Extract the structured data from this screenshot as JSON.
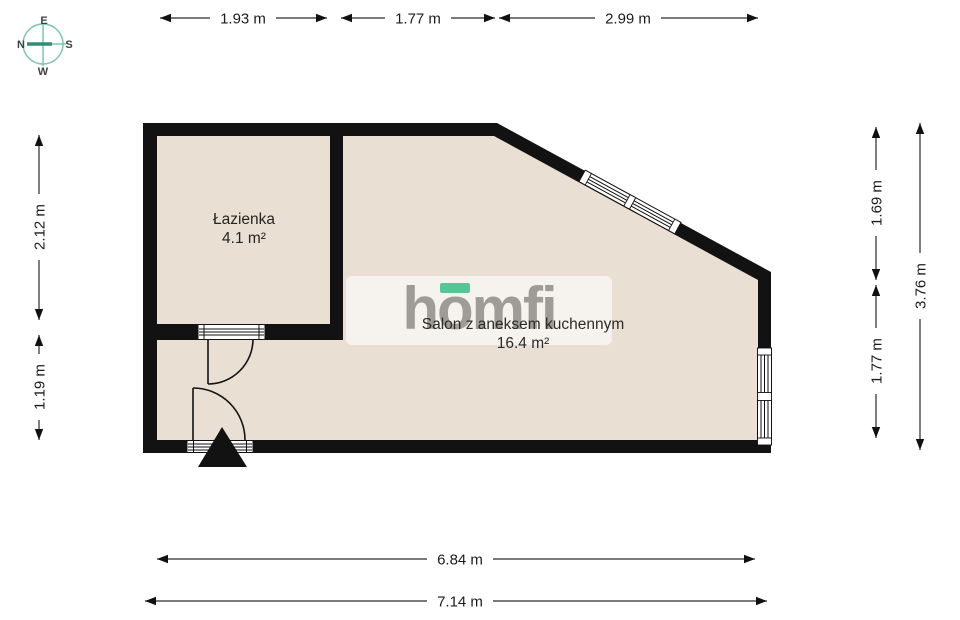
{
  "compass": {
    "top": "E",
    "right": "S",
    "bottom": "W",
    "left": "N"
  },
  "logo": {
    "part1": "h",
    "part2": "o",
    "part3": "mfi"
  },
  "rooms": {
    "bathroom": {
      "name": "Łazienka",
      "area": "4.1 m²"
    },
    "salon": {
      "name": "Salon z aneksem kuchennym",
      "area": "16.4 m²"
    }
  },
  "dims": {
    "top": [
      "1.93 m",
      "1.77 m",
      "2.99 m"
    ],
    "left": [
      "2.12 m",
      "1.19 m"
    ],
    "right": [
      "1.69 m",
      "1.77 m",
      "3.76 m"
    ],
    "bottom": [
      "6.84 m",
      "7.14 m"
    ]
  },
  "colors": {
    "wall": "#121212",
    "floor": "#e9dfd3",
    "accent_green": "#54c795",
    "compass_light": "#7cc5ae",
    "compass_dark": "#2d8e76",
    "logo_grey": "#8b8984"
  }
}
